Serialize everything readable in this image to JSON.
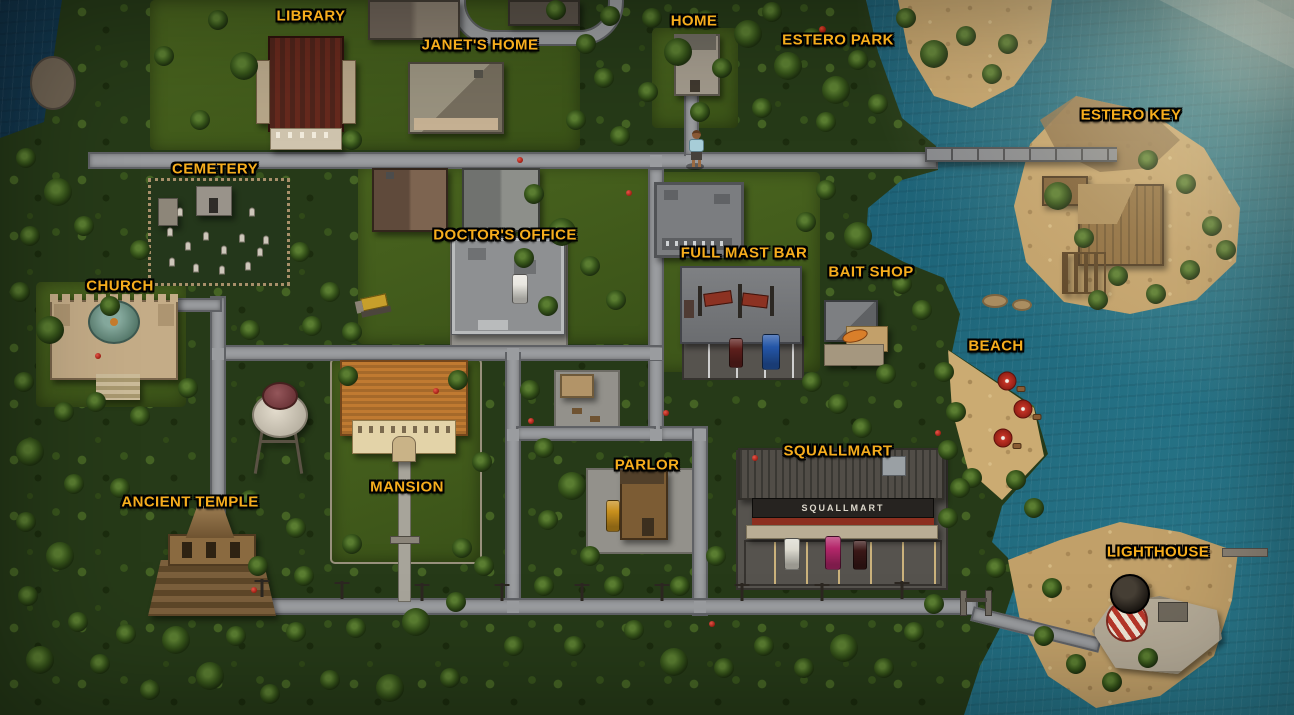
{
  "map": {
    "locations": [
      {
        "id": "library",
        "label": "LIBRARY",
        "x": 311,
        "y": 16
      },
      {
        "id": "janets-home",
        "label": "JANET'S HOME",
        "x": 480,
        "y": 45
      },
      {
        "id": "home",
        "label": "HOME",
        "x": 694,
        "y": 21
      },
      {
        "id": "estero-park",
        "label": "ESTERO PARK",
        "x": 838,
        "y": 40
      },
      {
        "id": "estero-key",
        "label": "ESTERO KEY",
        "x": 1131,
        "y": 115
      },
      {
        "id": "cemetery",
        "label": "CEMETERY",
        "x": 215,
        "y": 169
      },
      {
        "id": "doctors-office",
        "label": "DOCTOR'S OFFICE",
        "x": 505,
        "y": 235
      },
      {
        "id": "full-mast-bar",
        "label": "FULL MAST BAR",
        "x": 744,
        "y": 253
      },
      {
        "id": "bait-shop",
        "label": "BAIT SHOP",
        "x": 871,
        "y": 272
      },
      {
        "id": "church",
        "label": "CHURCH",
        "x": 120,
        "y": 286
      },
      {
        "id": "beach",
        "label": "BEACH",
        "x": 996,
        "y": 346
      },
      {
        "id": "squallmart",
        "label": "SQUALLMART",
        "x": 838,
        "y": 451
      },
      {
        "id": "parlor",
        "label": "PARLOR",
        "x": 647,
        "y": 465
      },
      {
        "id": "mansion",
        "label": "MANSION",
        "x": 407,
        "y": 487
      },
      {
        "id": "ancient-temple",
        "label": "ANCIENT TEMPLE",
        "x": 190,
        "y": 502
      },
      {
        "id": "lighthouse",
        "label": "LIGHTHOUSE",
        "x": 1158,
        "y": 552
      }
    ],
    "signs": {
      "squallmart": "SQUALLMART"
    },
    "markers": {
      "player": "player-character"
    },
    "colors": {
      "label_gold": "#f6ad1d",
      "label_outline": "#000000",
      "water": "#1a5a70",
      "jungle": "#263a18",
      "sand": "#c1a069",
      "road": "#9a9c9f",
      "squallmart_sign_text": "#ddd8cc"
    }
  }
}
